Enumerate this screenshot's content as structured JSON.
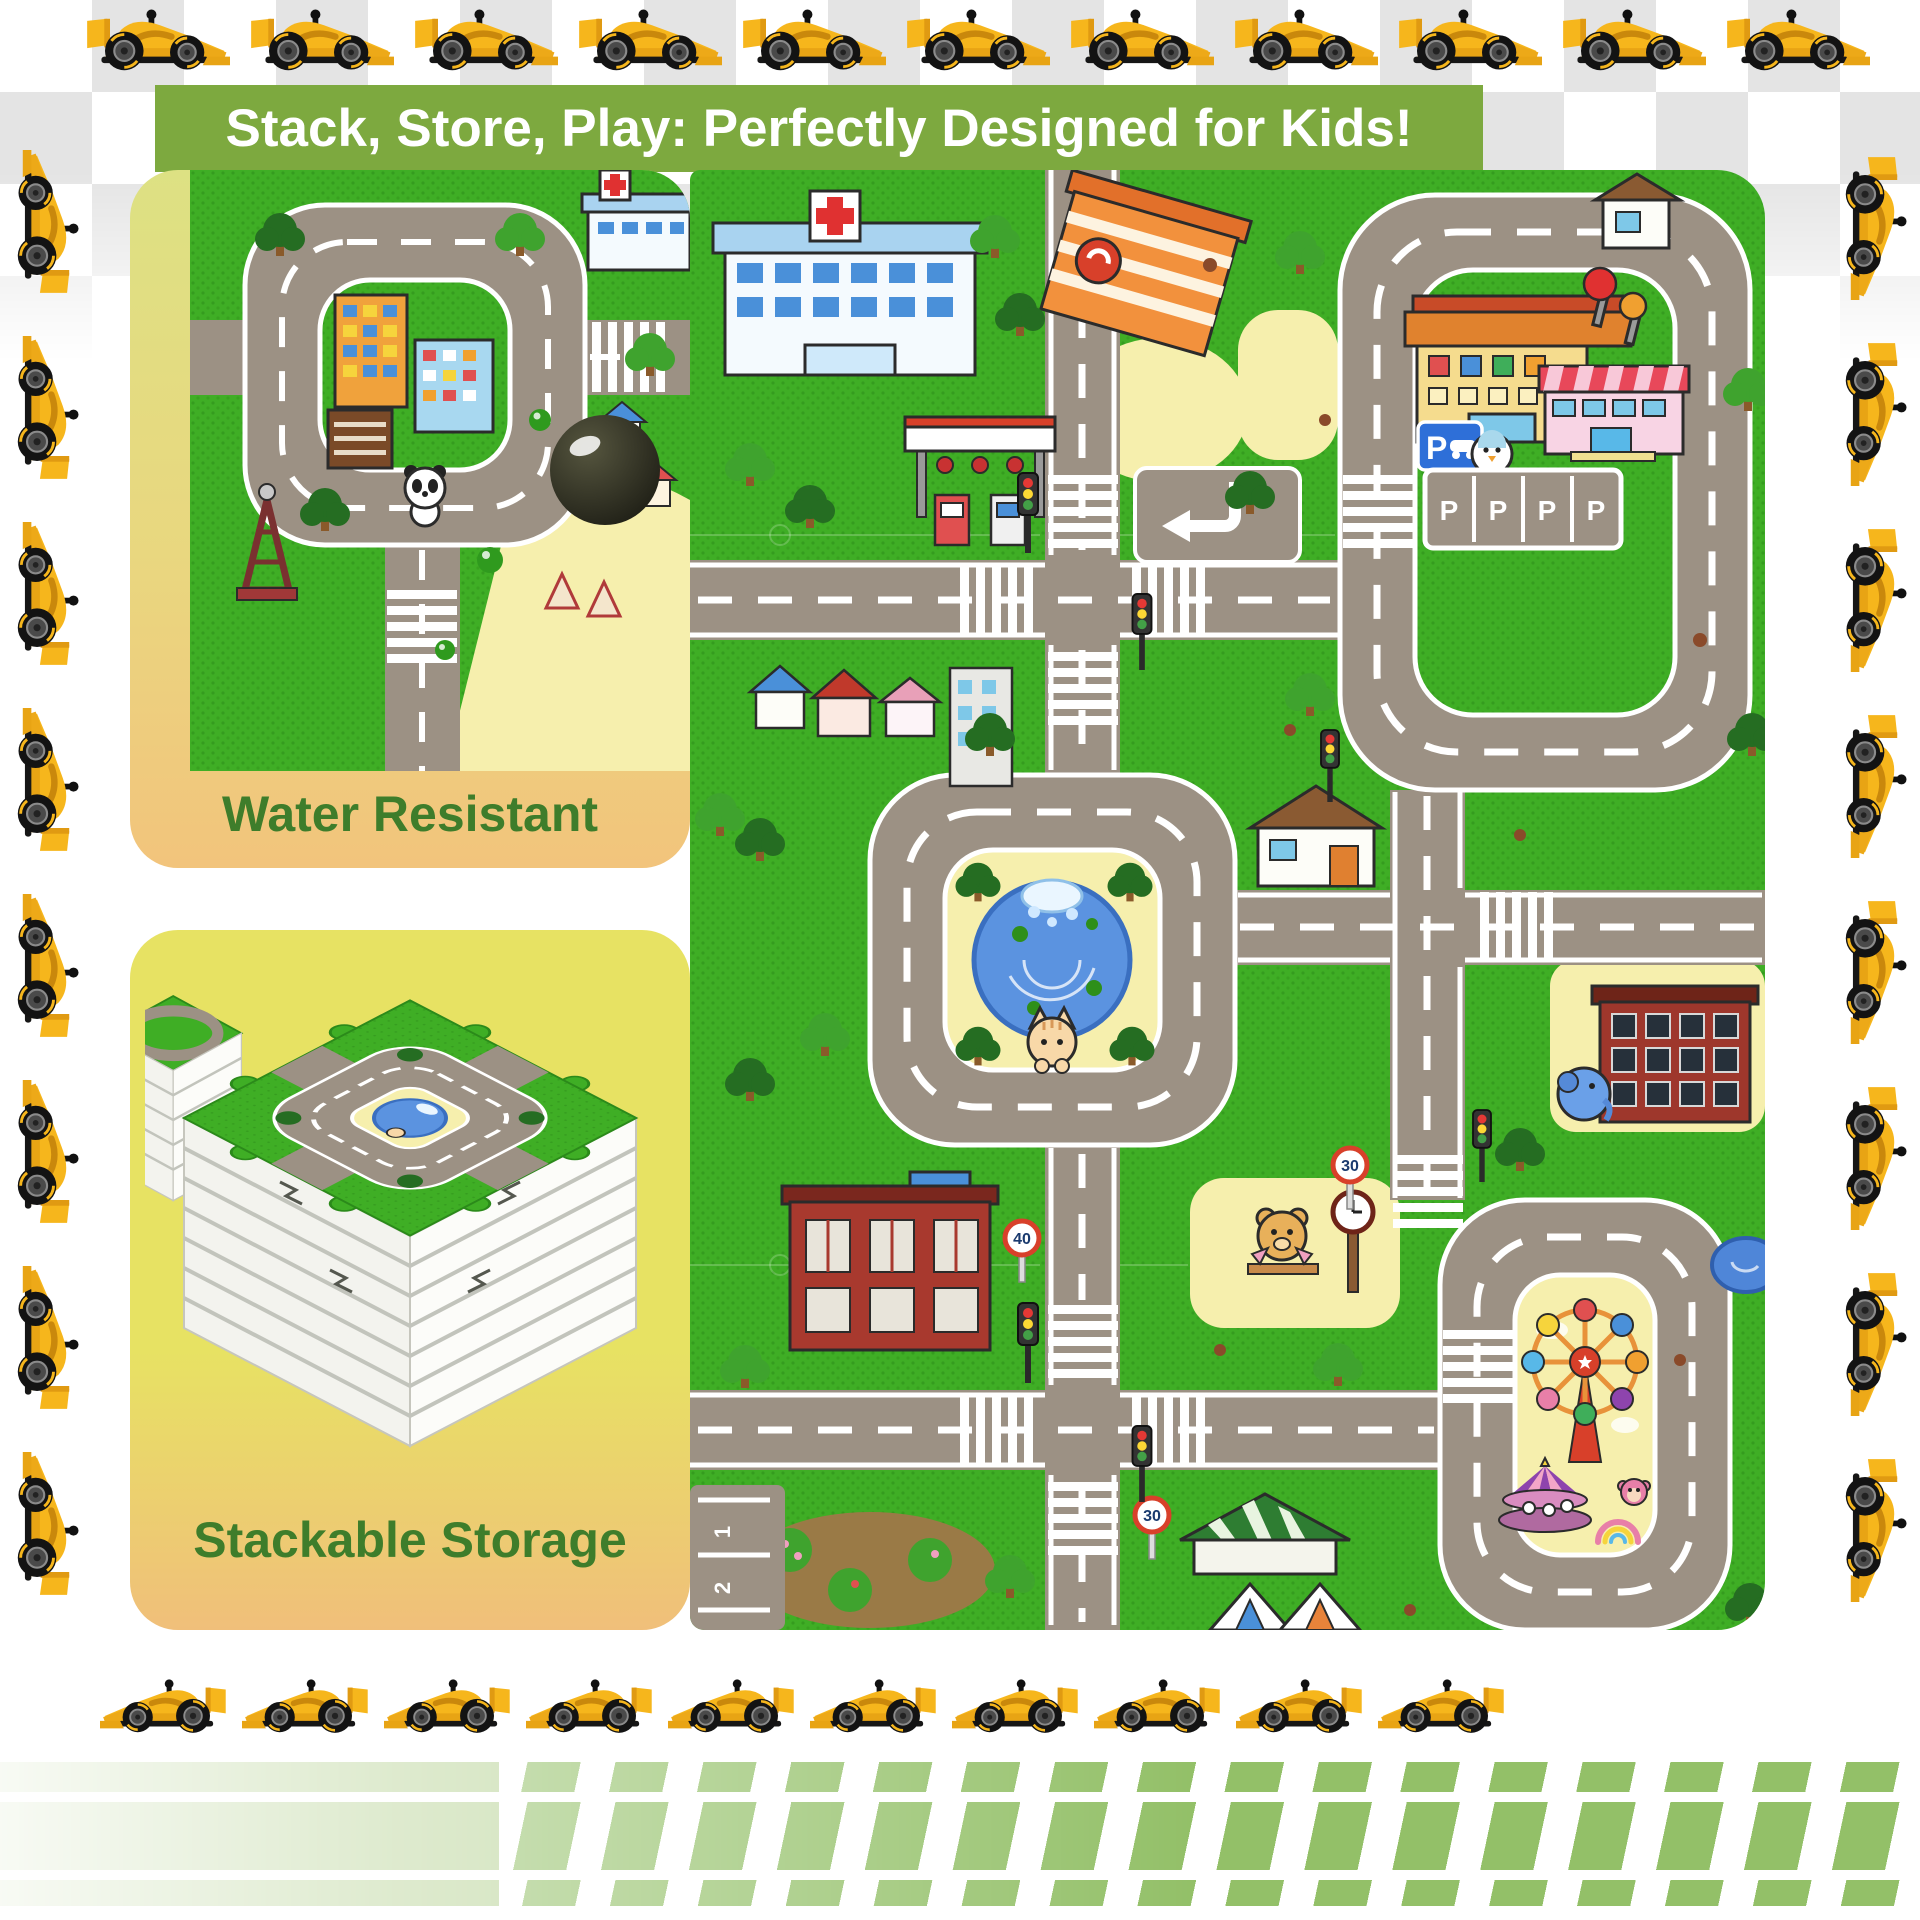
{
  "header": {
    "title": "Stack, Store, Play: Perfectly Designed for Kids!",
    "bg_color": "#7da93f",
    "text_color": "#ffffff"
  },
  "cards": {
    "label_color": "#3e7d2b",
    "water_resistant": {
      "label": "Water Resistant"
    },
    "stackable_storage": {
      "label": "Stackable Storage"
    }
  },
  "mat": {
    "parking_sign_letter": "P",
    "parking_bays": [
      "P",
      "P",
      "P",
      "P"
    ],
    "speed_signs": {
      "limit_40": "40",
      "limit_30": "30"
    },
    "lane_numbers": [
      "1",
      "2"
    ],
    "colors": {
      "grass": "#3fae25",
      "road": "#9c9184",
      "pond": "#5b93e0",
      "ground": "#f6efad"
    }
  },
  "decor": {
    "icons": {
      "border_car": "race-car-icon"
    },
    "race_car_color": "#f6b61c",
    "checker_color": "#e4e4e4",
    "stripe_color": "#93c068",
    "border_cars": {
      "top": 11,
      "bottom": 10,
      "left": 8,
      "right": 8
    }
  }
}
